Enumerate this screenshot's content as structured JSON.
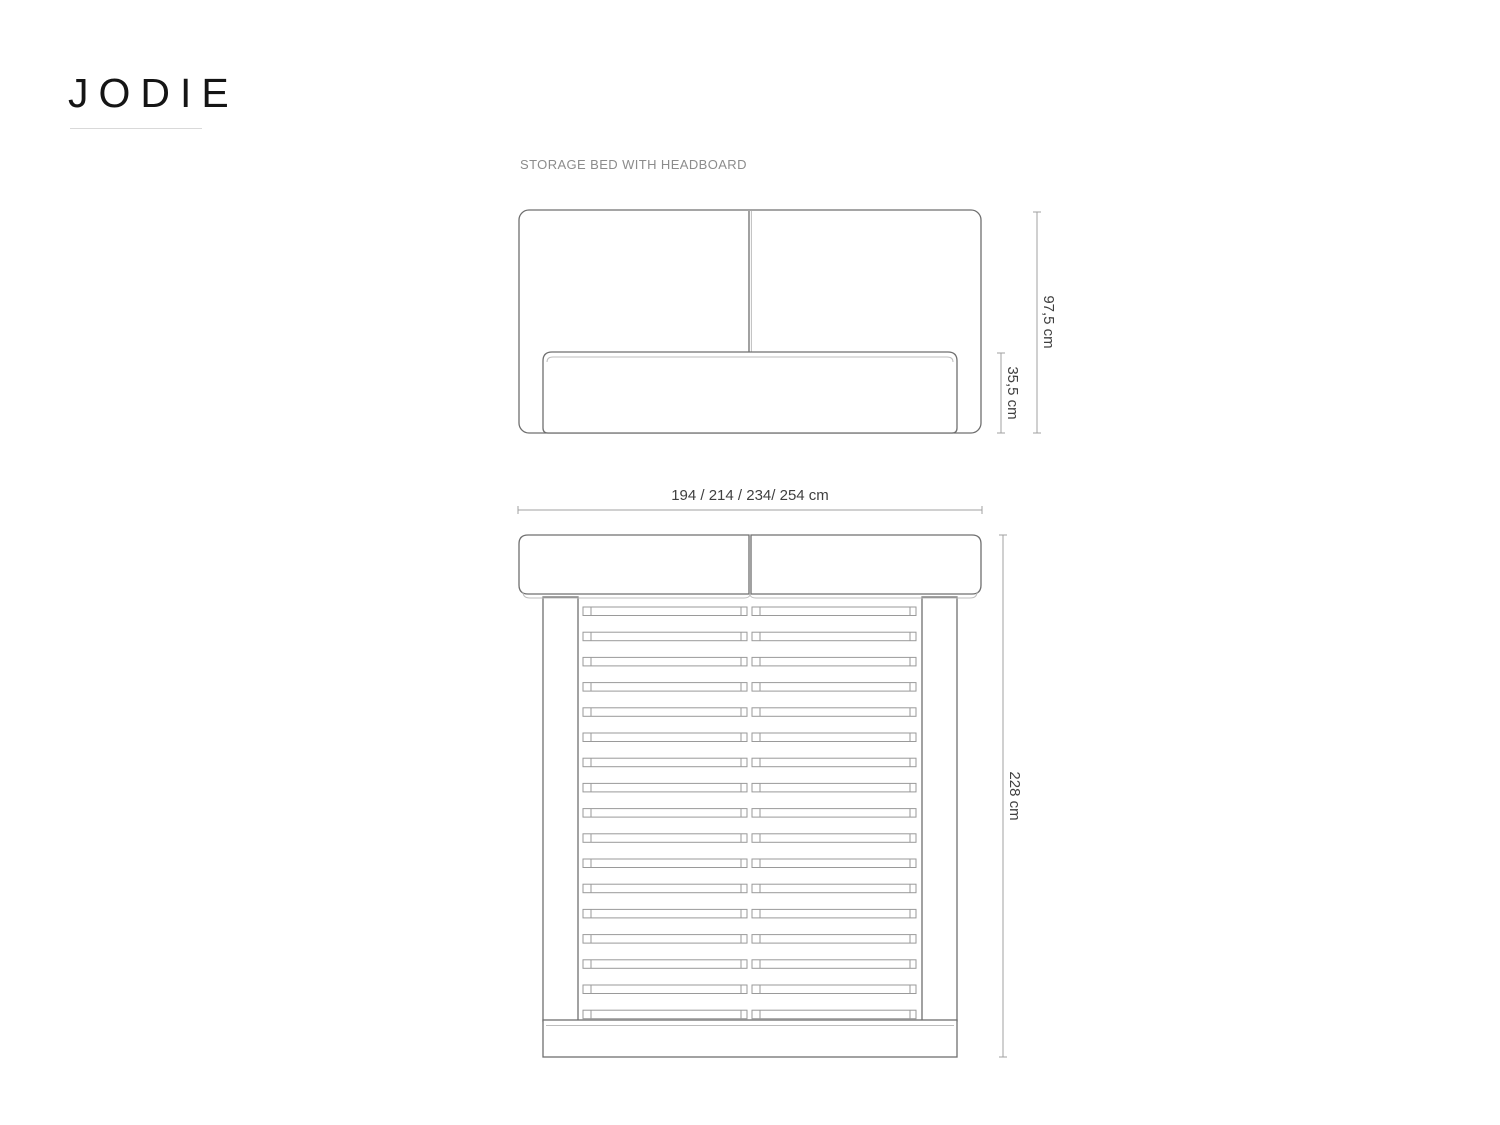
{
  "brand": {
    "logo": "JODIE"
  },
  "product": {
    "subtitle": "STORAGE BED WITH HEADBOARD"
  },
  "views": {
    "front": {
      "label": "front-elevation-of-storage-bed",
      "dim_height_total": "97,5 cm",
      "dim_height_base": "35,5 cm",
      "dim_widths": "194 / 214 / 234/ 254 cm"
    },
    "top": {
      "label": "top-plan-of-storage-bed",
      "dim_length": "228 cm",
      "slat_rows": 17
    }
  },
  "colors": {
    "background": "#ffffff",
    "line": "#6f6f6f",
    "line_light": "#bdbdbd",
    "dim_line": "#a0a0a0",
    "dim_text": "#3f3f3f",
    "subtitle_text": "#8c8c8c",
    "logo_text": "#151515",
    "underline": "#d9d9d9"
  }
}
